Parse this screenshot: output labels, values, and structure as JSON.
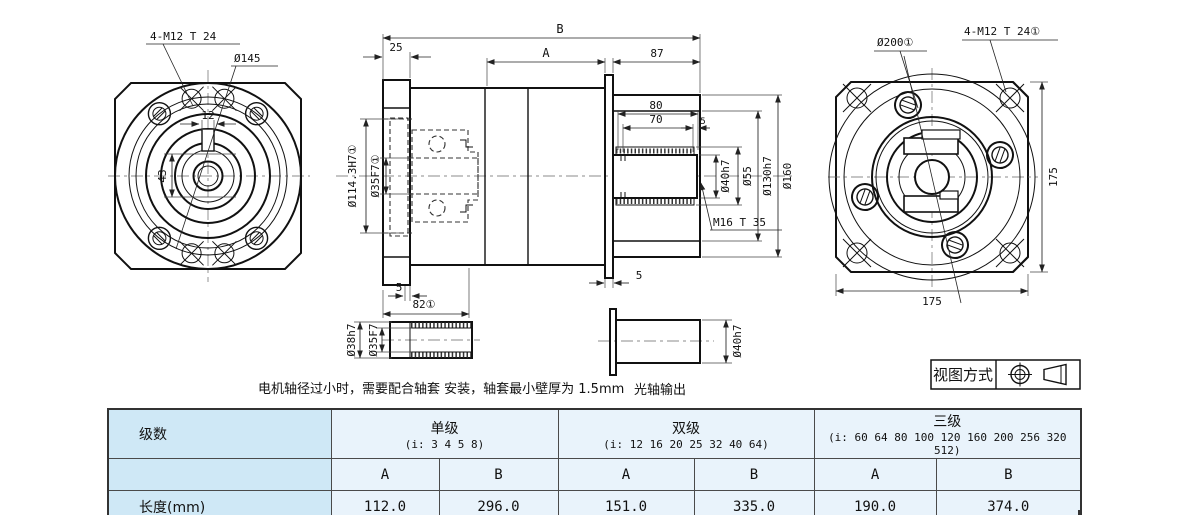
{
  "drawing": {
    "front_view": {
      "bolt_label": "4-M12 T 24",
      "diameter_label": "Ø145",
      "keyway_width": "12",
      "hub_height": "43"
    },
    "side_view": {
      "dim_total": "B",
      "dim_front": "25",
      "dim_mid": "A",
      "dim_rear": "87",
      "dim_80": "80",
      "dim_70": "70",
      "dim_5_right": "5",
      "d40": "Ø40h7",
      "d55": "Ø55",
      "d130": "Ø130h7",
      "d160": "Ø160",
      "m16": "M16 T 35",
      "d114": "Ø114.3H7①",
      "d35": "Ø35F7①",
      "dim_5_flange": "5",
      "dim_82": "82①",
      "dim_5_disc": "5"
    },
    "rear_view": {
      "d200": "Ø200①",
      "bolt_label": "4-M12 T 24①",
      "height": "175",
      "width": "175"
    },
    "bushing": {
      "d38": "Ø38h7",
      "d35": "Ø35F7"
    },
    "shaft_detail": {
      "d40": "Ø40h7",
      "caption": "光轴输出"
    },
    "note": "电机轴径过小时，需要配合轴套 安装，轴套最小壁厚为 1.5mm",
    "view_method": {
      "label": "视图方式",
      "symbols": [
        "first-angle-projection-icon",
        "cone-icon"
      ]
    }
  },
  "table": {
    "stage_header": "级数",
    "groups": [
      {
        "name": "单级",
        "ratios": "(i: 3 4 5 8)"
      },
      {
        "name": "双级",
        "ratios": "(i: 12 16 20 25 32 40 64)"
      },
      {
        "name": "三级",
        "ratios": "(i: 60 64 80 100 120 160 200 256 320 512)"
      }
    ],
    "sub_headers": [
      "A",
      "B",
      "A",
      "B",
      "A",
      "B"
    ],
    "length_row": {
      "label": "长度(mm)",
      "values": [
        "112.0",
        "296.0",
        "151.0",
        "335.0",
        "190.0",
        "374.0"
      ]
    }
  },
  "colors": {
    "header_bg": "#cfe8f6",
    "cell_bg": "#e9f3fb",
    "line": "#111111",
    "table_border": "#333333"
  }
}
